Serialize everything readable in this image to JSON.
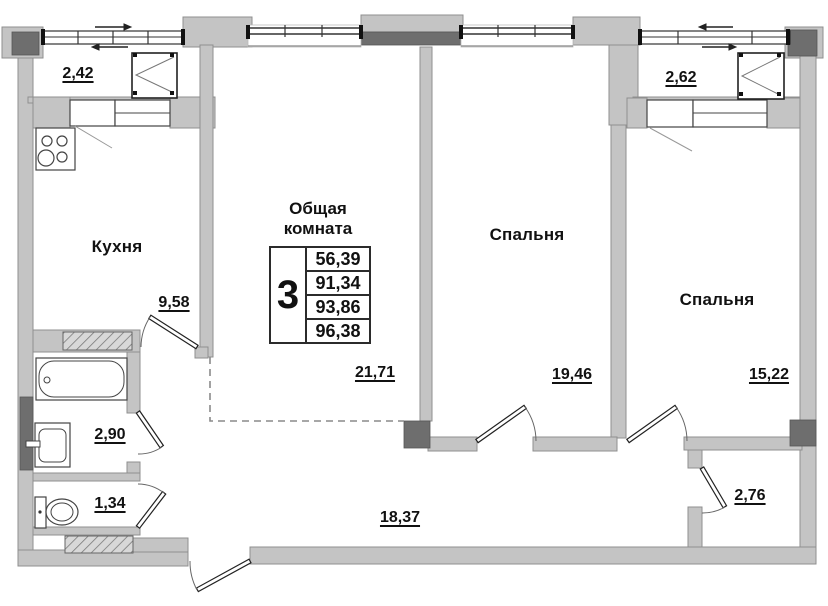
{
  "plan": {
    "colors": {
      "wall_fill": "#c4c4c4",
      "wall_dark": "#6e6e6e",
      "line": "#444444",
      "background": "#ffffff"
    },
    "rooms": {
      "balcony1": {
        "area": "2,42"
      },
      "balcony2": {
        "area": "2,62"
      },
      "kitchen": {
        "label": "Кухня",
        "area": "9,58"
      },
      "living": {
        "label_line1": "Общая",
        "label_line2": "комната",
        "area": "21,71",
        "table": {
          "rooms": "3",
          "values": [
            "56,39",
            "91,34",
            "93,86",
            "96,38"
          ]
        }
      },
      "bedroom1": {
        "label": "Спальня",
        "area": "19,46"
      },
      "bedroom2": {
        "label": "Спальня",
        "area": "15,22"
      },
      "bathroom": {
        "area": "2,90"
      },
      "toilet": {
        "area": "1,34"
      },
      "hallway": {
        "area": "18,37"
      },
      "storage": {
        "area": "2,76"
      }
    }
  }
}
